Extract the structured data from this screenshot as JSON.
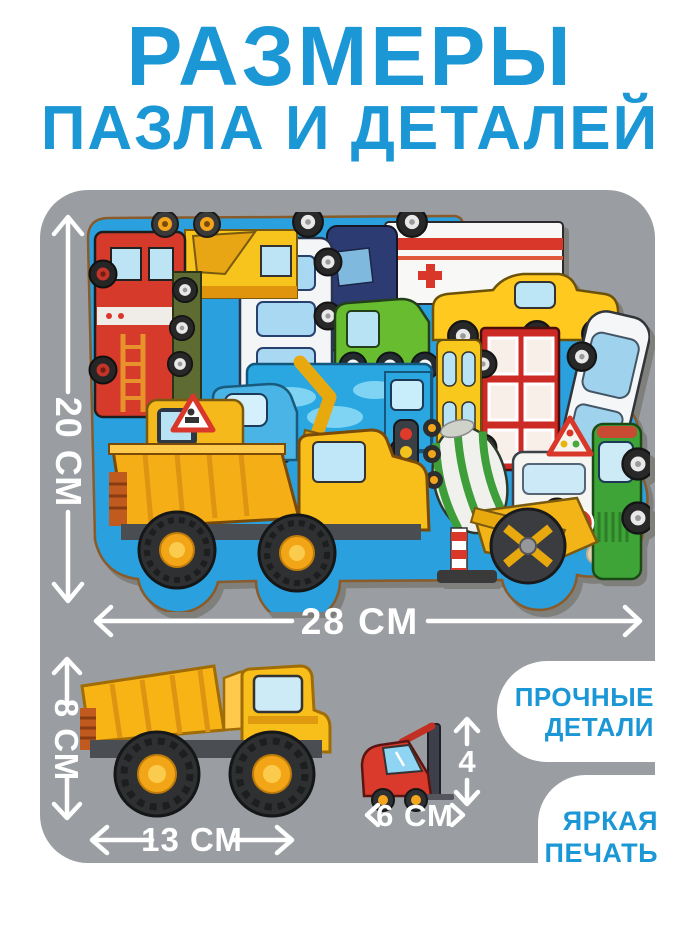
{
  "title": {
    "line1": "РАЗМЕРЫ",
    "line2": "ПАЗЛА И ДЕТАЛЕЙ"
  },
  "colors": {
    "accent_blue": "#1B97D6",
    "panel_gray": "#9A9EA2",
    "board_blue": "#2AA0DE",
    "label_white": "#FFFFFF"
  },
  "puzzle": {
    "height_label": "20 СМ",
    "width_label": "28 СМ",
    "vehicles": [
      "fire-truck",
      "crane-truck",
      "military-truck",
      "city-bus",
      "minivan",
      "ambulance",
      "green-lorry",
      "pickup-truck",
      "white-car",
      "double-decker-bus",
      "yellow-bus",
      "water-truck",
      "blue-cab-truck",
      "excavator",
      "concrete-mixer",
      "traffic-light",
      "camper-van",
      "tractor",
      "road-roller",
      "dump-truck",
      "stop-sign",
      "roadworks-sign",
      "warning-sign",
      "wooden-peg"
    ]
  },
  "truck_detail": {
    "name": "dump-truck",
    "height_label": "8 СМ",
    "width_label": "13 СМ"
  },
  "forklift_detail": {
    "name": "forklift",
    "height_label": "4",
    "width_label": "6 СМ"
  },
  "features": [
    {
      "line1": "ПРОЧНЫЕ",
      "line2": "ДЕТАЛИ"
    },
    {
      "line1": "ЯРКАЯ",
      "line2": "ПЕЧАТЬ"
    }
  ]
}
